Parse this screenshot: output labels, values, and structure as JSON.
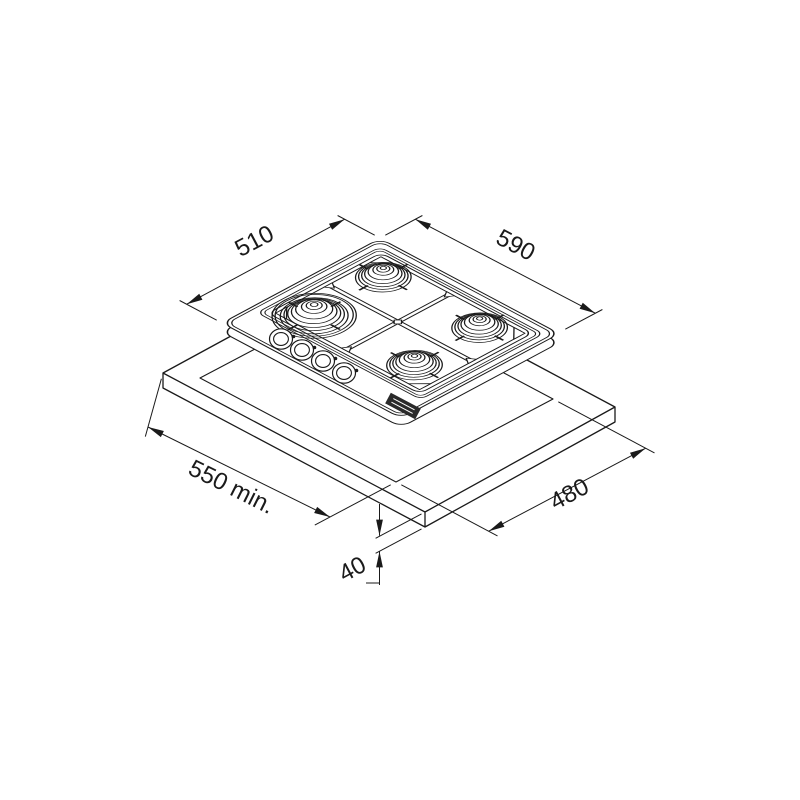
{
  "figure": {
    "type": "isometric-installation-drawing",
    "subject": "built-in 4-burner gas hob with worktop cutout",
    "line_color": "#1a1a1a",
    "background_color": "#ffffff"
  },
  "dimensions": {
    "hob_depth": {
      "label": "510"
    },
    "hob_width": {
      "label": "590"
    },
    "worktop_depth_min": {
      "label": "550 min."
    },
    "cutout_width": {
      "label": "480"
    },
    "worktop_thickness": {
      "label": "40"
    }
  }
}
